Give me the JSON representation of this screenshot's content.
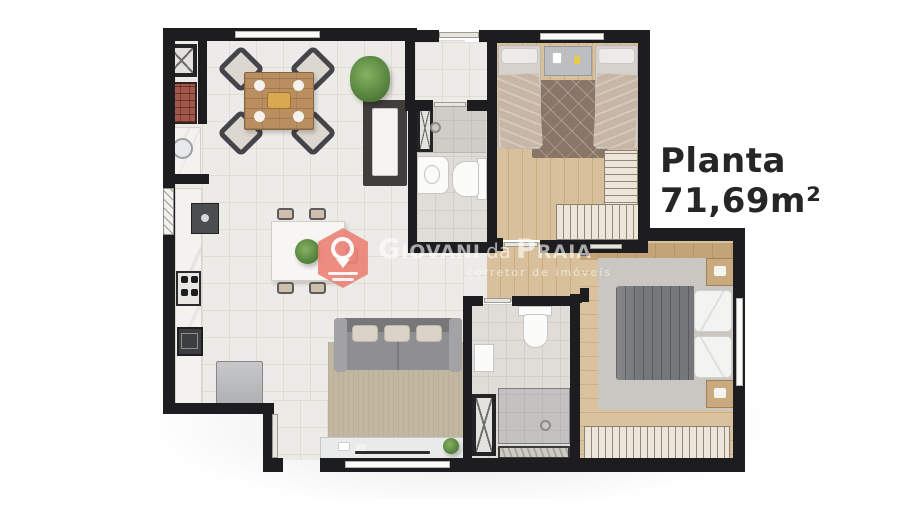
{
  "title": "Planta 71,69m²",
  "watermark": {
    "brand_giovani": "Giovani",
    "brand_da": "da",
    "brand_praia": "Praia",
    "subtitle": "corretor de imóveis",
    "logo_icon": "location-pin-icon"
  },
  "colors": {
    "brand_pin": "#ec8277",
    "wall": "#1d1d1f",
    "wood_floor": "#d6bf9a",
    "living_tile": "#edebe7",
    "bathroom_tile": "#e0dcd8",
    "title_text": "#262626",
    "plant_green": "#5c8a46",
    "page_background": "#ffffff"
  }
}
